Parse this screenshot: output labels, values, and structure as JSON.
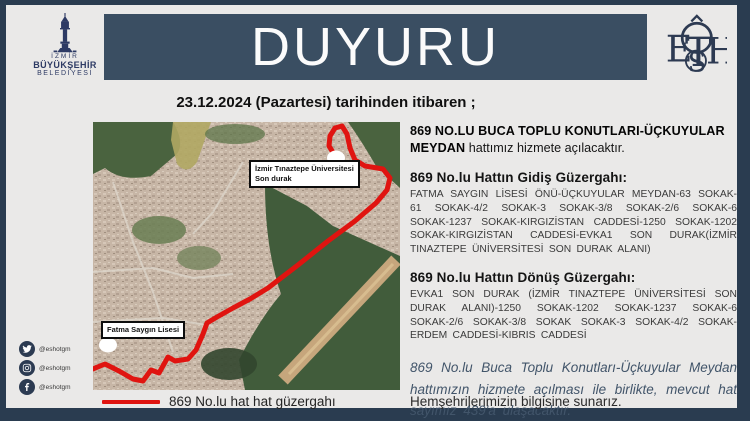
{
  "colors": {
    "outer_navy": "#2a3c50",
    "banner_slate": "#3a4e62",
    "card_bg": "#eae9e8",
    "route_red": "#e01410",
    "logo_navy": "#2d3a64",
    "note_text": "#42556a"
  },
  "header": {
    "title": "DUYURU",
    "izmir_logo": {
      "line1": "İZMİR",
      "line2": "BÜYÜKŞEHİR",
      "line3": "BELEDİYESİ"
    },
    "eshot_logo_letters": {
      "e": "E",
      "t": "T",
      "s": "S",
      "h": "H"
    }
  },
  "subtitle": "23.12.2024 (Pazartesi) tarihinden itibaren ;",
  "map": {
    "labels": {
      "university_stop": {
        "line1": "İzmir Tınaztepe Üniversitesi",
        "line2": "Son durak"
      },
      "school": "Fatma Saygın Lisesi"
    },
    "legend": "869 No.lu hat hat güzergahı"
  },
  "announcement": {
    "headline_bold": "869 NO.LU BUCA TOPLU KONUTLARI-ÜÇKUYULAR MEYDAN",
    "headline_rest": "hattımız hizmete açılacaktır.",
    "gidis_heading": "869 No.lu  Hattın Gidiş  Güzergahı:",
    "gidis_route": "FATMA SAYGIN LİSESİ ÖNÜ-ÜÇKUYULAR MEYDAN-63 SOKAK-61 SOKAK-4/2 SOKAK-3 SOKAK-3/8 SOKAK-2/6 SOKAK-6 SOKAK-1237 SOKAK-KIRGIZİSTAN CADDESİ-1250 SOKAK-1202 SOKAK-KIRGIZİSTAN CADDESİ-EVKA1 SON DURAK(İZMİR TINAZTEPE ÜNİVERSİTESİ SON DURAK ALANI)",
    "donus_heading": "869 No.lu  Hattın Dönüş  Güzergahı:",
    "donus_route": "EVKA1 SON DURAK (İZMİR TINAZTEPE ÜNİVERSİTESİ SON DURAK ALANI)-1250 SOKAK-1202 SOKAK-1237 SOKAK-6 SOKAK-2/6 SOKAK-3/8 SOKAK SOKAK-3 SOKAK-4/2 SOKAK-ERDEM CADDESİ-KIBRIS CADDESİ",
    "note_italic": "869 No.lu Buca Toplu Konutları-Üçkuyular Meydan  hattımızın hizmete açılması ile birlikte, mevcut hat sayımız 439'a ulaşacaktır.",
    "closing": "Hemşehrilerimizin bilgisine sunarız."
  },
  "social": {
    "handle": "@eshotgm",
    "icons": [
      "twitter-icon",
      "instagram-icon",
      "facebook-icon"
    ]
  }
}
